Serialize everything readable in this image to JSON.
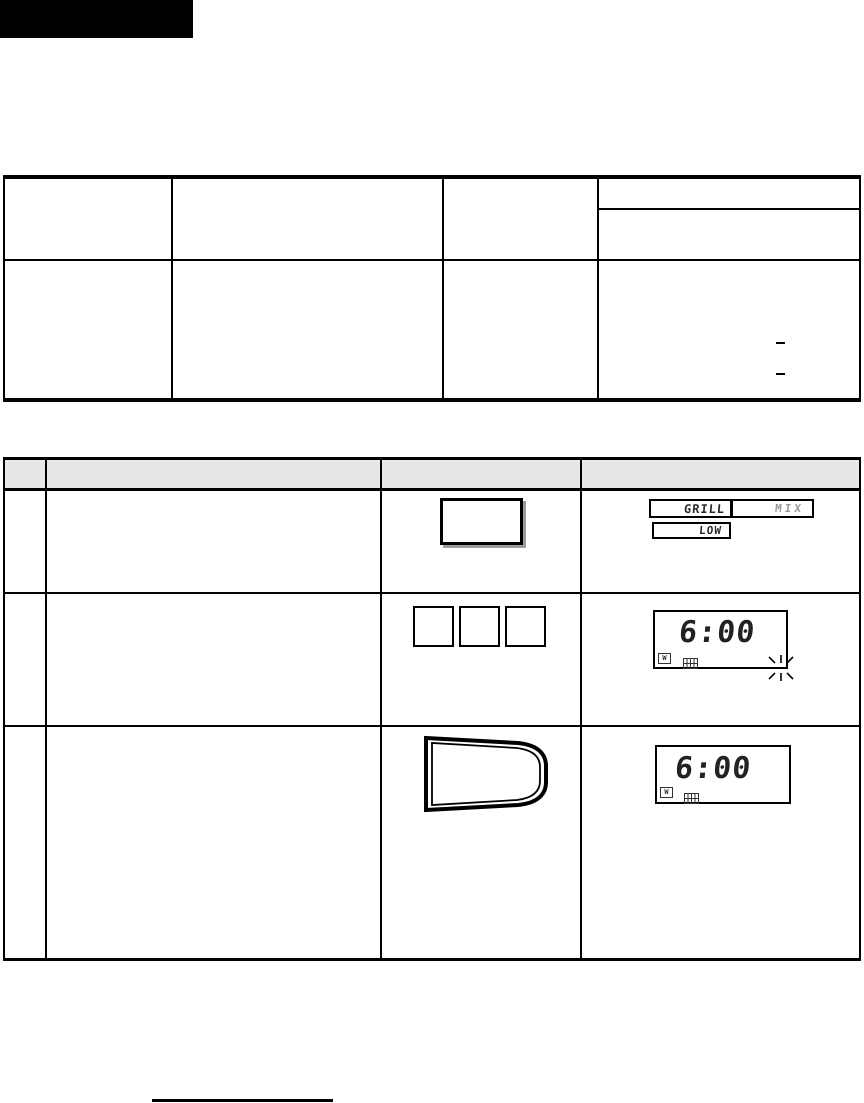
{
  "colors": {
    "line": "#000000",
    "table_header_fill": "#e7e7e7",
    "segment_text": "#2a2a2a",
    "dim_segment_text": "#9a9a9a",
    "button_shadow": "#9c9c9c"
  },
  "display_row1": {
    "boxes": [
      {
        "label": "GRILL"
      },
      {
        "label": "MIX"
      },
      {
        "label": "LOW"
      }
    ]
  },
  "display_row2": {
    "time": "6:00",
    "watt_symbol": "W"
  },
  "display_row3": {
    "time": "6:00",
    "watt_symbol": "W"
  },
  "icons": {
    "watt": "watt-letter-in-box",
    "grill": "grill-grid-box",
    "flashing": "burst-rays"
  }
}
